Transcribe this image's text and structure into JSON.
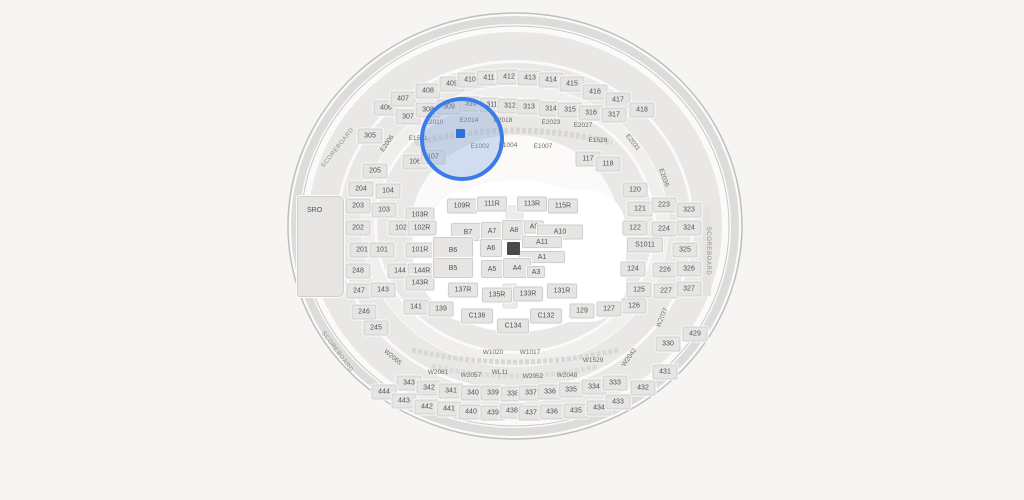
{
  "scene": {
    "background": "#f6f5f3",
    "colors": {
      "section_fill": "#e6e5e3",
      "section_border": "#d0cfcd",
      "label_text": "#525252",
      "aisle_text": "#6e6d6b",
      "highlight_blue": "#3b7ce8",
      "seat_blue": "#2f6fd8"
    },
    "sro": {
      "label": "SRO"
    },
    "scoreboard_labels": [
      {
        "text": "SCOREBOARD",
        "x": 338,
        "y": 148,
        "rot": -52
      },
      {
        "text": "SCOREBOARD",
        "x": 337,
        "y": 352,
        "rot": 53
      },
      {
        "text": "SCOREBOARD",
        "x": 708,
        "y": 251,
        "rot": 90
      }
    ],
    "sections": [
      {
        "l": "406",
        "x": 386,
        "y": 108
      },
      {
        "l": "407",
        "x": 403,
        "y": 99
      },
      {
        "l": "408",
        "x": 428,
        "y": 91
      },
      {
        "l": "409",
        "x": 452,
        "y": 84
      },
      {
        "l": "410",
        "x": 470,
        "y": 80
      },
      {
        "l": "411",
        "x": 489,
        "y": 78
      },
      {
        "l": "412",
        "x": 509,
        "y": 77
      },
      {
        "l": "413",
        "x": 530,
        "y": 78
      },
      {
        "l": "414",
        "x": 551,
        "y": 80
      },
      {
        "l": "415",
        "x": 572,
        "y": 84
      },
      {
        "l": "416",
        "x": 595,
        "y": 92
      },
      {
        "l": "417",
        "x": 618,
        "y": 100
      },
      {
        "l": "418",
        "x": 642,
        "y": 110
      },
      {
        "l": "305",
        "x": 370,
        "y": 136
      },
      {
        "l": "307",
        "x": 408,
        "y": 117
      },
      {
        "l": "308",
        "x": 428,
        "y": 110
      },
      {
        "l": "309",
        "x": 449,
        "y": 107
      },
      {
        "l": "310",
        "x": 471,
        "y": 104
      },
      {
        "l": "311",
        "x": 492,
        "y": 105
      },
      {
        "l": "312",
        "x": 510,
        "y": 106
      },
      {
        "l": "313",
        "x": 529,
        "y": 107
      },
      {
        "l": "314",
        "x": 551,
        "y": 109
      },
      {
        "l": "315",
        "x": 570,
        "y": 110
      },
      {
        "l": "316",
        "x": 591,
        "y": 113
      },
      {
        "l": "317",
        "x": 614,
        "y": 115
      },
      {
        "l": "106",
        "x": 415,
        "y": 162
      },
      {
        "l": "107",
        "x": 433,
        "y": 157
      },
      {
        "l": "117",
        "x": 588,
        "y": 159
      },
      {
        "l": "118",
        "x": 608,
        "y": 164
      },
      {
        "l": "205",
        "x": 375,
        "y": 171
      },
      {
        "l": "204",
        "x": 361,
        "y": 189
      },
      {
        "l": "104",
        "x": 388,
        "y": 191
      },
      {
        "l": "120",
        "x": 635,
        "y": 190
      },
      {
        "l": "203",
        "x": 358,
        "y": 206
      },
      {
        "l": "103",
        "x": 384,
        "y": 210
      },
      {
        "l": "103R",
        "x": 420,
        "y": 215,
        "w": 29
      },
      {
        "l": "202",
        "x": 358,
        "y": 228
      },
      {
        "l": "102",
        "x": 401,
        "y": 228
      },
      {
        "l": "102R",
        "x": 422,
        "y": 228,
        "w": 29
      },
      {
        "l": "201",
        "x": 362,
        "y": 250
      },
      {
        "l": "101",
        "x": 382,
        "y": 250
      },
      {
        "l": "101R",
        "x": 420,
        "y": 250,
        "w": 29
      },
      {
        "l": "248",
        "x": 358,
        "y": 271
      },
      {
        "l": "144",
        "x": 400,
        "y": 271
      },
      {
        "l": "144R",
        "x": 422,
        "y": 271,
        "w": 29
      },
      {
        "l": "247",
        "x": 359,
        "y": 291
      },
      {
        "l": "143",
        "x": 383,
        "y": 290
      },
      {
        "l": "143R",
        "x": 420,
        "y": 283,
        "w": 29
      },
      {
        "l": "246",
        "x": 364,
        "y": 312
      },
      {
        "l": "245",
        "x": 376,
        "y": 328
      },
      {
        "l": "121",
        "x": 640,
        "y": 209
      },
      {
        "l": "223",
        "x": 664,
        "y": 205
      },
      {
        "l": "323",
        "x": 689,
        "y": 210
      },
      {
        "l": "122",
        "x": 635,
        "y": 228
      },
      {
        "l": "224",
        "x": 664,
        "y": 229
      },
      {
        "l": "324",
        "x": 689,
        "y": 228
      },
      {
        "l": "S1011",
        "x": 645,
        "y": 245,
        "w": 36
      },
      {
        "l": "325",
        "x": 685,
        "y": 250
      },
      {
        "l": "124",
        "x": 633,
        "y": 269
      },
      {
        "l": "226",
        "x": 665,
        "y": 270
      },
      {
        "l": "326",
        "x": 689,
        "y": 269
      },
      {
        "l": "125",
        "x": 639,
        "y": 290
      },
      {
        "l": "227",
        "x": 666,
        "y": 291
      },
      {
        "l": "327",
        "x": 689,
        "y": 289
      },
      {
        "l": "126",
        "x": 634,
        "y": 306
      },
      {
        "l": "127",
        "x": 609,
        "y": 309
      },
      {
        "l": "429",
        "x": 695,
        "y": 334
      },
      {
        "l": "330",
        "x": 668,
        "y": 344
      },
      {
        "l": "431",
        "x": 665,
        "y": 372
      },
      {
        "l": "109R",
        "x": 462,
        "y": 206,
        "w": 30
      },
      {
        "l": "111R",
        "x": 492,
        "y": 204,
        "w": 30
      },
      {
        "l": "113R",
        "x": 532,
        "y": 204,
        "w": 30
      },
      {
        "l": "115R",
        "x": 563,
        "y": 206,
        "w": 30
      },
      {
        "l": "B7",
        "x": 468,
        "y": 232,
        "w": 34,
        "h": 18
      },
      {
        "l": "A7",
        "x": 492,
        "y": 231,
        "w": 22,
        "h": 18
      },
      {
        "l": "A8",
        "x": 514,
        "y": 230,
        "w": 24,
        "h": 20
      },
      {
        "l": "A9",
        "x": 534,
        "y": 227,
        "w": 20,
        "h": 13
      },
      {
        "l": "A10",
        "x": 560,
        "y": 232,
        "w": 46,
        "h": 15
      },
      {
        "l": "B6",
        "x": 453,
        "y": 250,
        "w": 40,
        "h": 26
      },
      {
        "l": "A6",
        "x": 491,
        "y": 248,
        "w": 22,
        "h": 18
      },
      {
        "l": "A11",
        "x": 542,
        "y": 242,
        "w": 40,
        "h": 12
      },
      {
        "l": "A1",
        "x": 542,
        "y": 257,
        "w": 46,
        "h": 12
      },
      {
        "l": "B5",
        "x": 453,
        "y": 268,
        "w": 40,
        "h": 20
      },
      {
        "l": "A5",
        "x": 492,
        "y": 269,
        "w": 22,
        "h": 18
      },
      {
        "l": "A4",
        "x": 517,
        "y": 268,
        "w": 28,
        "h": 20
      },
      {
        "l": "A3",
        "x": 536,
        "y": 272,
        "w": 18,
        "h": 12
      },
      {
        "l": "137R",
        "x": 463,
        "y": 290,
        "w": 30
      },
      {
        "l": "135R",
        "x": 497,
        "y": 295,
        "w": 30
      },
      {
        "l": "133R",
        "x": 528,
        "y": 294,
        "w": 30
      },
      {
        "l": "131R",
        "x": 562,
        "y": 291,
        "w": 30
      },
      {
        "l": "141",
        "x": 416,
        "y": 307
      },
      {
        "l": "139",
        "x": 441,
        "y": 309
      },
      {
        "l": "C136",
        "x": 477,
        "y": 316,
        "w": 32
      },
      {
        "l": "C134",
        "x": 513,
        "y": 326,
        "w": 32
      },
      {
        "l": "C132",
        "x": 546,
        "y": 316,
        "w": 32
      },
      {
        "l": "129",
        "x": 582,
        "y": 311
      },
      {
        "l": "343",
        "x": 409,
        "y": 383
      },
      {
        "l": "342",
        "x": 429,
        "y": 388
      },
      {
        "l": "341",
        "x": 451,
        "y": 391
      },
      {
        "l": "340",
        "x": 473,
        "y": 393
      },
      {
        "l": "339",
        "x": 493,
        "y": 393
      },
      {
        "l": "338",
        "x": 513,
        "y": 394
      },
      {
        "l": "337",
        "x": 531,
        "y": 393
      },
      {
        "l": "336",
        "x": 550,
        "y": 392
      },
      {
        "l": "335",
        "x": 571,
        "y": 390
      },
      {
        "l": "334",
        "x": 594,
        "y": 387
      },
      {
        "l": "333",
        "x": 615,
        "y": 383
      },
      {
        "l": "444",
        "x": 384,
        "y": 392
      },
      {
        "l": "443",
        "x": 404,
        "y": 401
      },
      {
        "l": "442",
        "x": 427,
        "y": 407
      },
      {
        "l": "441",
        "x": 449,
        "y": 409
      },
      {
        "l": "440",
        "x": 471,
        "y": 412
      },
      {
        "l": "439",
        "x": 493,
        "y": 413
      },
      {
        "l": "438",
        "x": 512,
        "y": 411
      },
      {
        "l": "437",
        "x": 531,
        "y": 413
      },
      {
        "l": "436",
        "x": 552,
        "y": 412
      },
      {
        "l": "435",
        "x": 576,
        "y": 411
      },
      {
        "l": "434",
        "x": 599,
        "y": 408
      },
      {
        "l": "433",
        "x": 618,
        "y": 402
      },
      {
        "l": "432",
        "x": 643,
        "y": 388
      }
    ],
    "aisle_labels": [
      {
        "l": "E2006",
        "x": 388,
        "y": 144,
        "rot": -55
      },
      {
        "l": "E2010",
        "x": 434,
        "y": 123
      },
      {
        "l": "E2014",
        "x": 469,
        "y": 121
      },
      {
        "l": "E2018",
        "x": 503,
        "y": 121
      },
      {
        "l": "E2023",
        "x": 551,
        "y": 123
      },
      {
        "l": "E2027",
        "x": 583,
        "y": 126
      },
      {
        "l": "E2031",
        "x": 632,
        "y": 143,
        "rot": 52
      },
      {
        "l": "E2036",
        "x": 663,
        "y": 178,
        "rot": 70
      },
      {
        "l": "E1501",
        "x": 418,
        "y": 139
      },
      {
        "l": "E1002",
        "x": 480,
        "y": 147
      },
      {
        "l": "E1004",
        "x": 508,
        "y": 146
      },
      {
        "l": "E1007",
        "x": 543,
        "y": 147
      },
      {
        "l": "E1528",
        "x": 598,
        "y": 141
      },
      {
        "l": "W1020",
        "x": 493,
        "y": 353
      },
      {
        "l": "W1017",
        "x": 530,
        "y": 353
      },
      {
        "l": "W1529",
        "x": 593,
        "y": 361
      },
      {
        "l": "W2061",
        "x": 438,
        "y": 373
      },
      {
        "l": "W2057",
        "x": 471,
        "y": 376
      },
      {
        "l": "WL11",
        "x": 500,
        "y": 373
      },
      {
        "l": "W2052",
        "x": 533,
        "y": 377
      },
      {
        "l": "W2048",
        "x": 567,
        "y": 376
      },
      {
        "l": "W2065",
        "x": 392,
        "y": 358,
        "rot": 40
      },
      {
        "l": "W2042",
        "x": 630,
        "y": 358,
        "rot": -55
      },
      {
        "l": "W2037",
        "x": 663,
        "y": 318,
        "rot": -66
      }
    ],
    "highlight": {
      "cx": 462,
      "cy": 139,
      "r": 42,
      "seat_x": 456,
      "seat_y": 129,
      "seat_size": 9
    }
  }
}
